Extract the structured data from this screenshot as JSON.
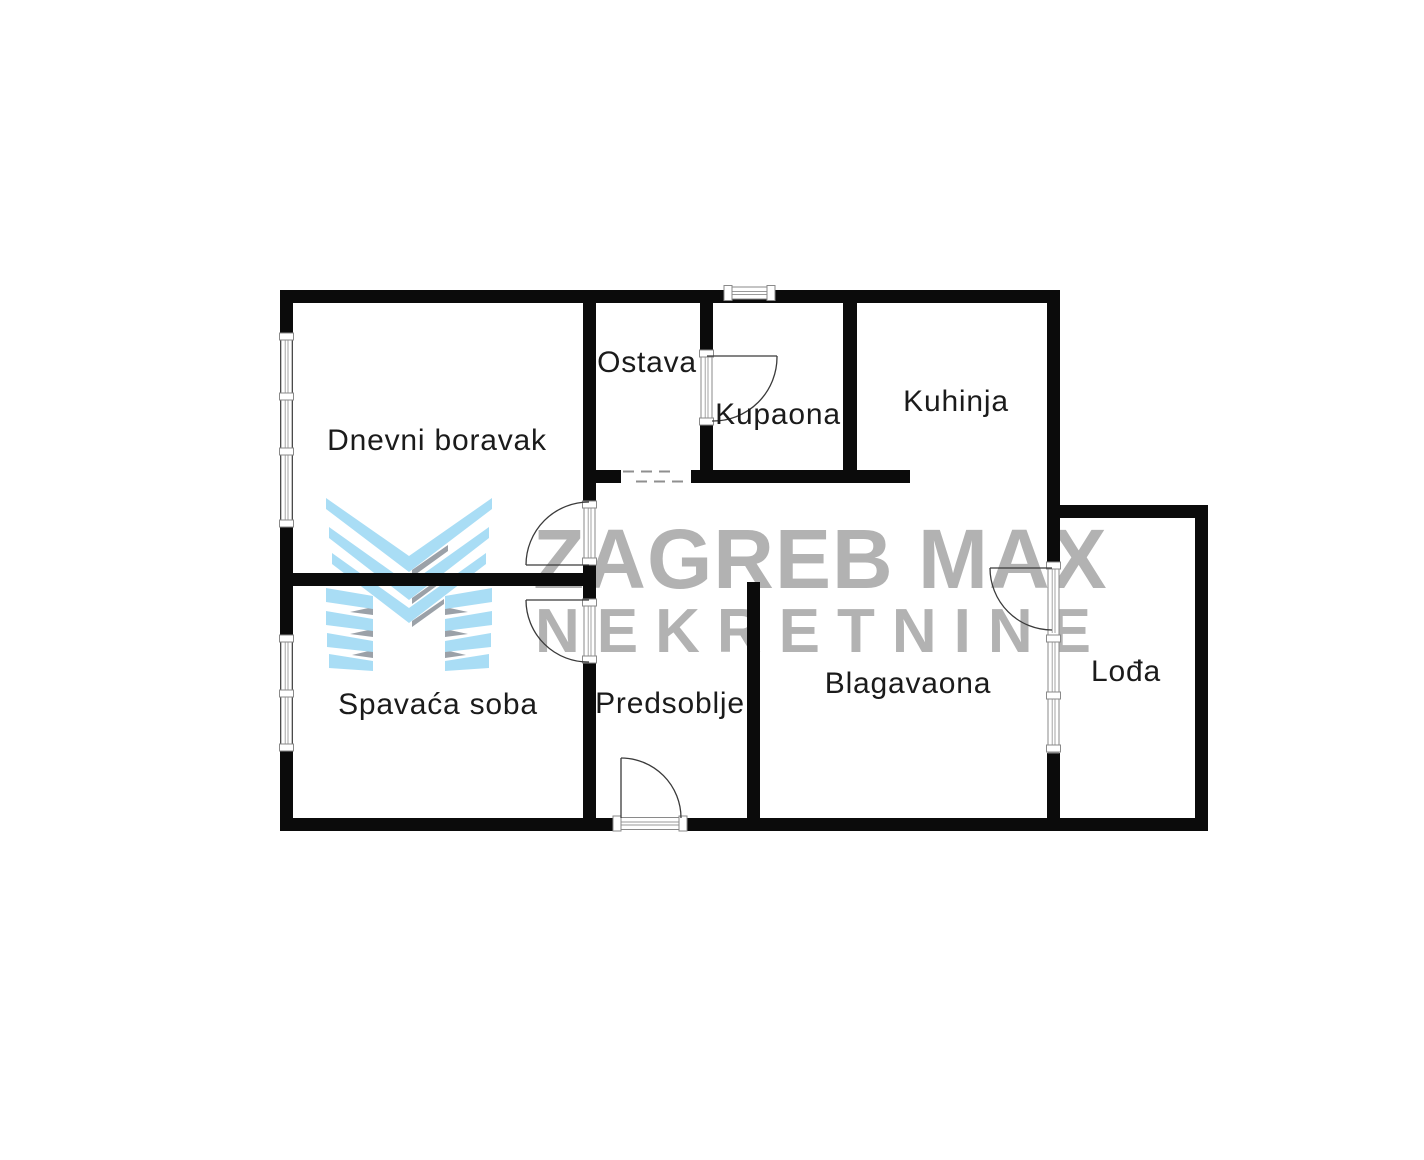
{
  "watermark": {
    "line1": "ZAGREB MAX",
    "line2": "NEKRETNINE"
  },
  "rooms": [
    {
      "id": "dnevni-boravak",
      "label": "Dnevni boravak"
    },
    {
      "id": "ostava",
      "label": "Ostava"
    },
    {
      "id": "kupaona",
      "label": "Kupaona"
    },
    {
      "id": "kuhinja",
      "label": "Kuhinja"
    },
    {
      "id": "spavaca-soba",
      "label": "Spavaća soba"
    },
    {
      "id": "predsoblje",
      "label": "Predsoblje"
    },
    {
      "id": "blagavaona",
      "label": "Blagavaona"
    },
    {
      "id": "lodja",
      "label": "Lođa"
    }
  ],
  "colors": {
    "wall": "#0b0b0b",
    "label": "#1b1b1b",
    "watermark_gray": "#b2b2b2",
    "logo_blue": "#a9ddf5",
    "logo_shadow_gray": "#9ba1a8",
    "background": "#ffffff"
  }
}
